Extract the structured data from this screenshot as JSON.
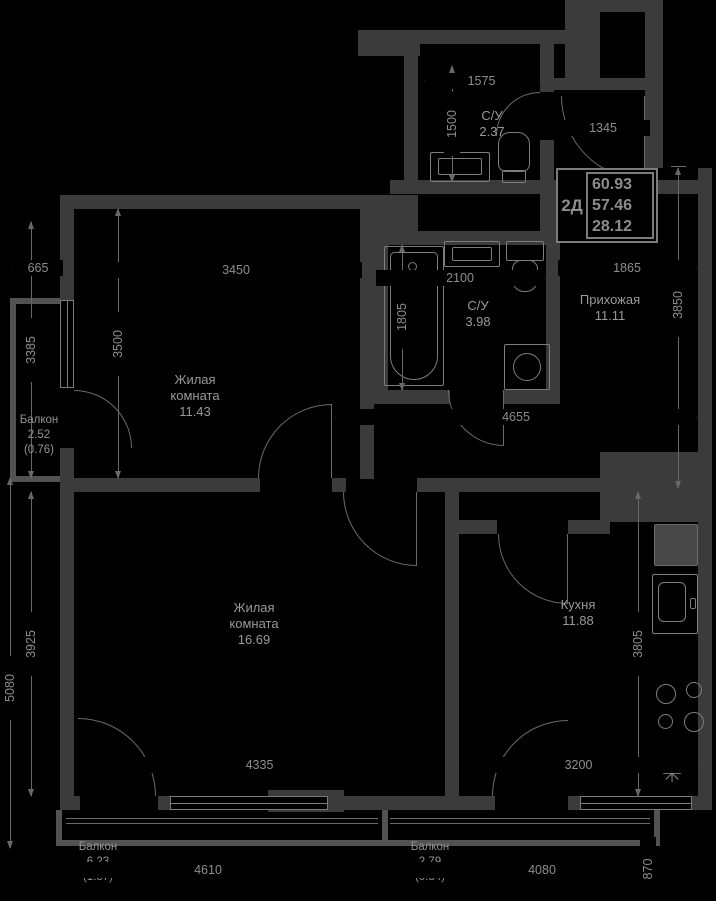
{
  "info_box": {
    "type_label": "2Д",
    "area_rows": [
      "60.93",
      "57.46",
      "28.12"
    ]
  },
  "rooms": {
    "living1": {
      "line1": "Жилая",
      "line2": "комната",
      "area": "11.43"
    },
    "living2": {
      "line1": "Жилая",
      "line2": "комната",
      "area": "16.69"
    },
    "kitchen": {
      "line1": "Кухня",
      "area": "11.88"
    },
    "hallway": {
      "line1": "Прихожая",
      "area": "11.11"
    },
    "bathroom_small": {
      "line1": "С/У",
      "area": "2.37"
    },
    "bathroom_large": {
      "line1": "С/У",
      "area": "3.98"
    },
    "balcony_left": {
      "line1": "Балкон",
      "area": "2.52",
      "reduced": "(0.76)"
    },
    "balcony_bottom_left": {
      "line1": "Балкон",
      "area": "6.23",
      "reduced": "(1.87)"
    },
    "balcony_bottom_right": {
      "line1": "Балкон",
      "area": "2.79",
      "reduced": "(0.84)"
    }
  },
  "dimensions_mm": {
    "balcony_left_width": "665",
    "balcony_left_height": "3385",
    "room1_width": "3450",
    "room1_height": "3500",
    "su_top_width": "1575",
    "su_top_height": "1500",
    "entry_opening": "1345",
    "bath_width": "2100",
    "bath_height": "1805",
    "hallway_width": "1865",
    "hallway_height": "3850",
    "corridor_span": "4655",
    "room2_height": "3925",
    "lower_section_height": "5080",
    "room2_width": "4335",
    "kitchen_width": "3200",
    "kitchen_height": "3805",
    "balcony_bl_width": "4610",
    "balcony_br_width": "4080",
    "balcony_br_depth": "870"
  },
  "symbols": {
    "snowflake": "✳"
  },
  "colors": {
    "background": "#000000",
    "wall": "#3b3b3b",
    "wall_light": "#525252",
    "line": "#6a6a6a",
    "room_text": "#999999",
    "dim_text": "#8d8d8d",
    "info_border": "#7c7c7c"
  }
}
